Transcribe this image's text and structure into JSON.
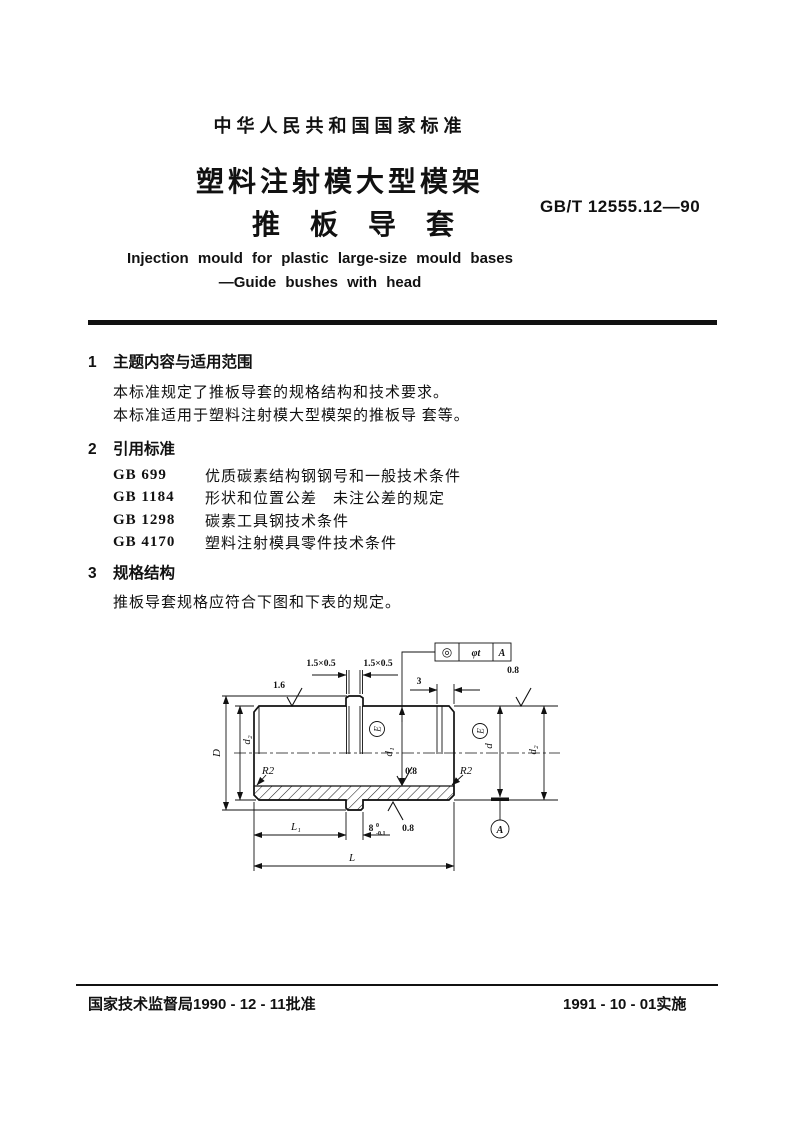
{
  "page": {
    "header": "中华人民共和国国家标准",
    "title_line1": "塑料注射模大型模架",
    "title_line2": "推板导套",
    "standard_number": "GB/T 12555.12—90",
    "english_title_line1": "Injection mould for plastic large-size mould bases",
    "english_title_line2": "—Guide bushes with head"
  },
  "sections": {
    "s1": {
      "number": "1",
      "title": "主题内容与适用范围",
      "para1": "本标准规定了推板导套的规格结构和技术要求。",
      "para2": "本标准适用于塑料注射模大型模架的推板导 套等。"
    },
    "s2": {
      "number": "2",
      "title": "引用标准",
      "refs": [
        {
          "code": "GB 699",
          "title": "优质碳素结构钢钢号和一般技术条件"
        },
        {
          "code": "GB 1184",
          "title": "形状和位置公差　未注公差的规定"
        },
        {
          "code": "GB 1298",
          "title": "碳素工具钢技术条件"
        },
        {
          "code": "GB 4170",
          "title": "塑料注射模具零件技术条件"
        }
      ]
    },
    "s3": {
      "number": "3",
      "title": "规格结构",
      "para1": "推板导套规格应符合下图和下表的规定。"
    }
  },
  "drawing": {
    "labels": {
      "chamfer": "1.5×0.5",
      "finish_rough": "1.6",
      "finish_fine": "0.8",
      "dim_3": "3",
      "dim_D": "D",
      "dim_d1": "d₁",
      "dim_d2": "d₂",
      "dim_d": "d",
      "radius": "R2",
      "fit_mark": "E",
      "dim_L1": "L₁",
      "dim_8": "8",
      "tol_upper": "0",
      "tol_lower": "-0.1",
      "dim_L": "L",
      "fcf_symbol": "◎",
      "fcf_value": "φt",
      "fcf_datum": "A",
      "datum": "A"
    }
  },
  "footer": {
    "left": "国家技术监督局1990 - 12 - 11批准",
    "right": "1991 - 10 - 01实施"
  }
}
